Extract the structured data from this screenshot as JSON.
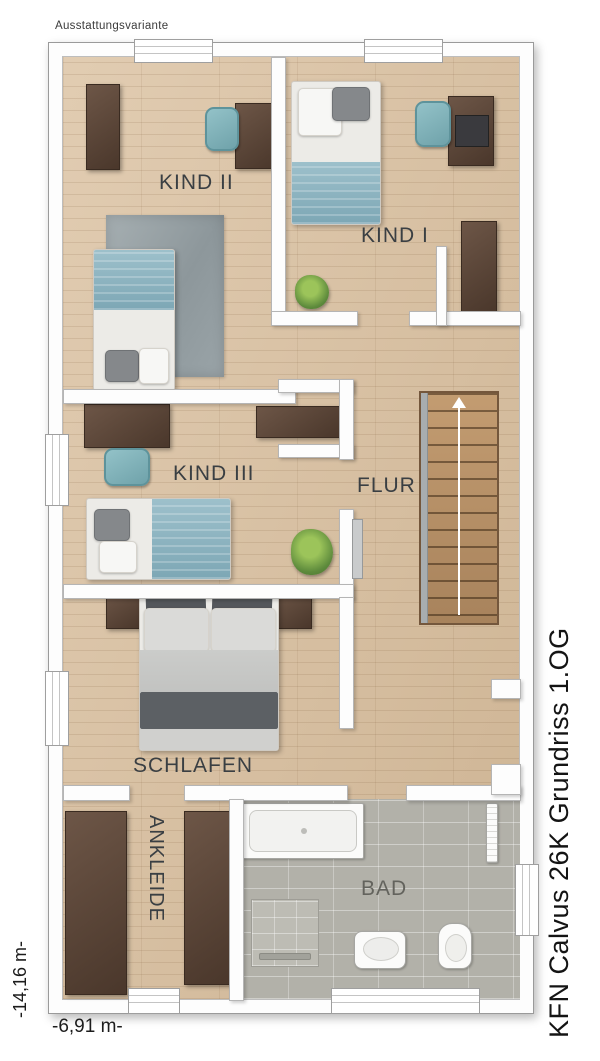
{
  "annotations": {
    "variant_label": "Ausstattungsvariante",
    "plan_title": "KFN Calvus 26K Grundriss 1.OG",
    "dimension_height": "-14,16 m-",
    "dimension_width": "-6,91 m-"
  },
  "rooms": {
    "kind2": {
      "label": "KIND II"
    },
    "kind1": {
      "label": "KIND I"
    },
    "kind3": {
      "label": "KIND III"
    },
    "flur": {
      "label": "FLUR"
    },
    "schlafen": {
      "label": "SCHLAFEN"
    },
    "ankleide": {
      "label": "ANKLEIDE"
    },
    "bad": {
      "label": "BAD"
    }
  },
  "furniture": {
    "kind2": [
      "wardrobe",
      "desk",
      "desk-chair",
      "single-bed",
      "rug"
    ],
    "kind1": [
      "single-bed",
      "desk",
      "desk-chair",
      "laptop",
      "wardrobe",
      "plant"
    ],
    "kind3": [
      "desk",
      "desk-chair",
      "single-bed",
      "sideboard",
      "plant"
    ],
    "flur": [
      "staircase-up"
    ],
    "schlafen": [
      "double-bed",
      "nightstand-left",
      "nightstand-right"
    ],
    "ankleide": [
      "wardrobe-left",
      "wardrobe-right"
    ],
    "bad": [
      "bathtub",
      "shower",
      "washbasin",
      "toilet",
      "towel-radiator"
    ]
  },
  "stairs": {
    "direction": "up"
  },
  "colors": {
    "wood_floor": "#d9be9c",
    "tile_floor": "#b2b1a9",
    "dark_wood": "#5d4737",
    "teal_fabric": "#8fb6c2",
    "rug_gray": "#9aa4a9",
    "linen_light": "#ececea",
    "cushion_dark": "#55585c",
    "plant_green": "#6fa03f",
    "wall": "#ffffff",
    "label_text": "#3a3f43"
  }
}
